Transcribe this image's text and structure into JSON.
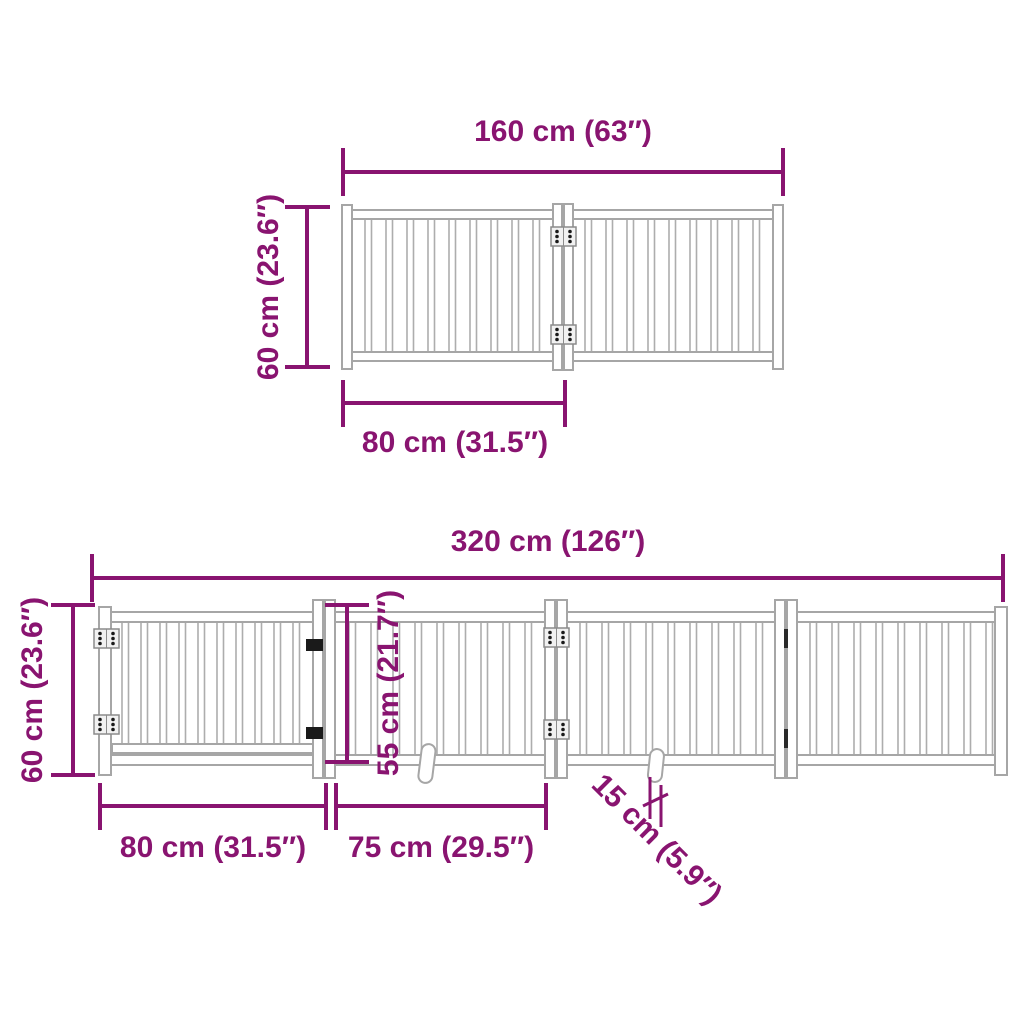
{
  "colors": {
    "dimension_accent": "#891470",
    "outline_gray": "#a6a6a6",
    "hinge_dark": "#1a1a1a",
    "background": "#ffffff"
  },
  "top_diagram": {
    "description": "2-section foldable gate, front view",
    "total_width": "160 cm (63″)",
    "height": "60 cm (23.6″)",
    "panel_width": "80 cm (31.5″)"
  },
  "bottom_diagram": {
    "description": "4-section foldable gate with door, front view",
    "total_width": "320 cm (126″)",
    "height": "60 cm (23.6″)",
    "door_height": "55 cm (21.7″)",
    "first_panel_width": "80 cm (31.5″)",
    "second_panel_width": "75 cm (29.5″)",
    "foot_length": "15 cm (5.9″)"
  }
}
